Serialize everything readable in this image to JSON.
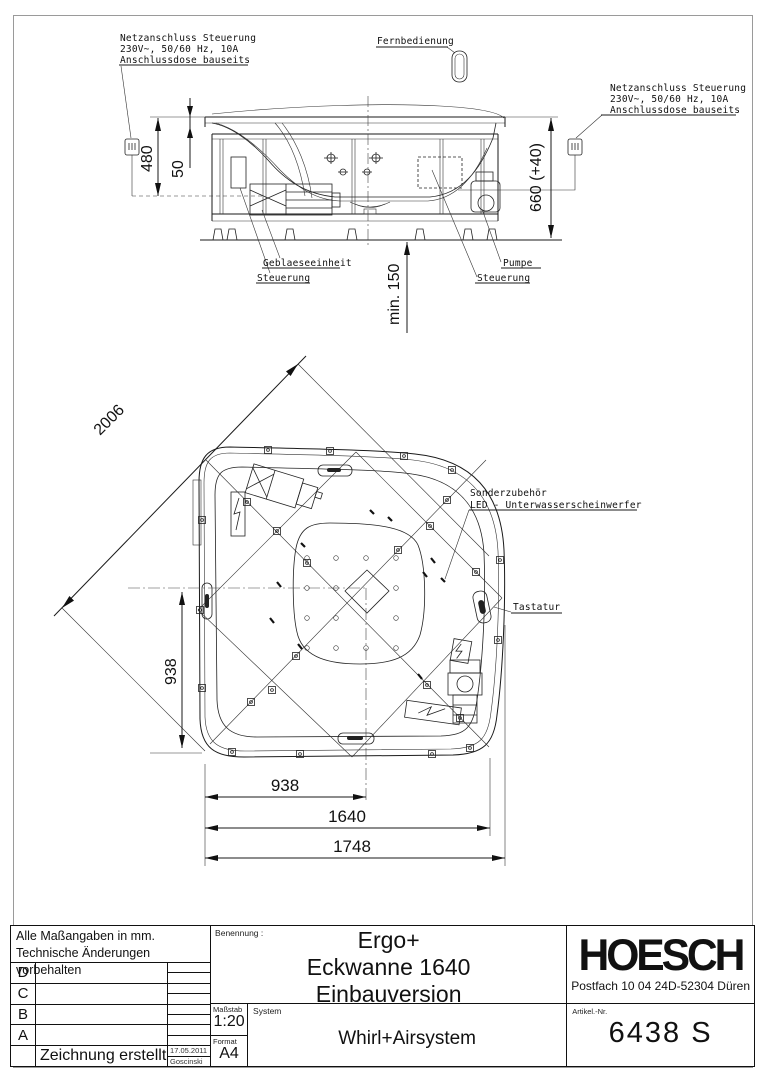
{
  "annotations": {
    "netz_left": {
      "line1": "Netzanschluss Steuerung",
      "line2": "230V~, 50/60 Hz, 10A",
      "line3": "Anschlussdose bauseits"
    },
    "netz_right": {
      "line1": "Netzanschluss Steuerung",
      "line2": "230V~, 50/60 Hz, 10A",
      "line3": "Anschlussdose bauseits"
    },
    "fernbedienung": "Fernbedienung",
    "geblaeseeinheit": "Geblaeseeinheit",
    "geblaese_steuerung": "Steuerung",
    "pumpe": "Pumpe",
    "pumpe_steuerung": "Steuerung",
    "sonderzubehoer_line1": "Sonderzubehör",
    "sonderzubehoer_line2": "LED - Unterwasserscheinwerfer",
    "tastatur": "Tastatur"
  },
  "dimensions": {
    "height_rim": "480",
    "rim_edge": "50",
    "height_total": "660 (+40)",
    "min_clearance": "min. 150",
    "diagonal": "2006",
    "center_left": "938",
    "center_bottom": "938",
    "wall_length": "1640",
    "overall_width": "1748"
  },
  "title_block": {
    "note_line1": "Alle Maßangaben in mm.",
    "note_line2": "Technische Änderungen vorbehalten",
    "rev_rows": [
      "D",
      "C",
      "B",
      "A"
    ],
    "created_label": "Zeichnung erstellt",
    "created_date": "17.05.2011",
    "created_by": "Goscinski",
    "benennung_label": "Benennung :",
    "title_line1": "Ergo+",
    "title_line2": "Eckwanne 1640",
    "title_line3": "Einbauversion",
    "massstab_label": "Maßstab",
    "massstab_value": "1:20",
    "format_label": "Format",
    "format_value": "A4",
    "system_label": "System",
    "system_value": "Whirl+Airsystem",
    "brand": "HOESCH",
    "address_left": "Postfach 10 04 24",
    "address_right": "D-52304 Düren",
    "artikel_label": "Artikel.-Nr.",
    "artikel_value": "6438 S"
  }
}
